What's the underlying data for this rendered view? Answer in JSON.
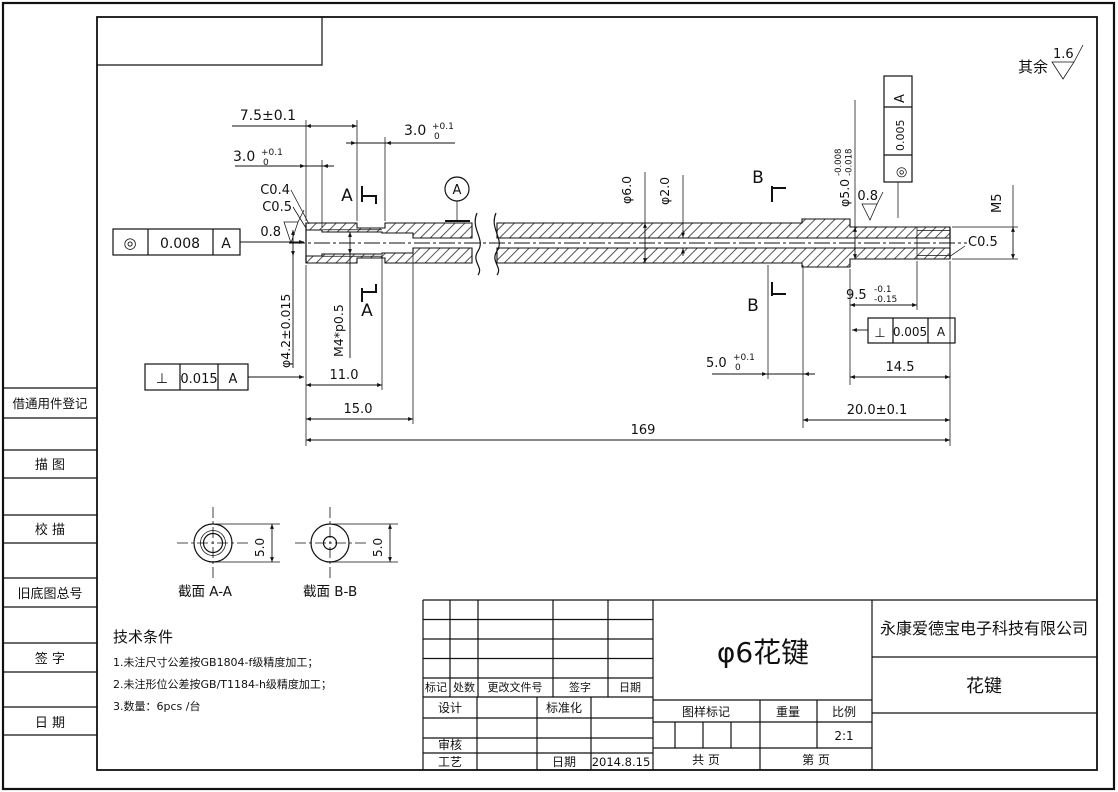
{
  "frame": {
    "margin_labels": [
      "借通用件登记",
      "描  图",
      "校  描",
      "旧底图总号",
      "签  字",
      "日  期"
    ]
  },
  "finish": {
    "prefix": "其余",
    "value": "1.6",
    "ra_left": "0.8",
    "ra_right": "0.8"
  },
  "dims": {
    "len_7_5": "7.5±0.1",
    "dep_3_0": {
      "v": "3.0",
      "sup": "+0.1",
      "sub": "0"
    },
    "grv_3_0": {
      "v": "3.0",
      "sup": "+0.1",
      "sub": "0"
    },
    "c0_4": "C0.4",
    "c0_5_left": "C0.5",
    "c0_5_right": "C0.5",
    "dia_4_2": "φ4.2±0.015",
    "thread_m4": "M4*p0.5",
    "thread_m5": "M5",
    "len_11": "11.0",
    "len_15": "15.0",
    "len_169": "169",
    "dia_6": "φ6.0",
    "dia_2": "φ2.0",
    "dia_5": {
      "v": "φ5.0",
      "sup": "-0.008",
      "sub": "-0.018"
    },
    "grv_5_0": {
      "v": "5.0",
      "sup": "+0.1",
      "sub": "0"
    },
    "len_9_5": {
      "v": "9.5",
      "sup": "-0.1",
      "sub": "-0.15"
    },
    "len_14_5": "14.5",
    "len_20": "20.0±0.1"
  },
  "gdt": {
    "conc_left": {
      "sym": "◎",
      "tol": "0.008",
      "datum": "A"
    },
    "perp_left": {
      "sym": "⊥",
      "tol": "0.015",
      "datum": "A"
    },
    "conc_right": {
      "sym": "◎",
      "tol": "0.005",
      "datum": "A"
    },
    "perp_right": {
      "sym": "⊥",
      "tol": "0.005",
      "datum": "A"
    }
  },
  "sections": {
    "a": "A",
    "b": "B",
    "datum": "A",
    "label_a": "截面  A-A",
    "label_b": "截面  B-B",
    "dim_a": "5.0",
    "dim_b": "5.0"
  },
  "notes": {
    "title": "技术条件",
    "items": [
      "1.未注尺寸公差按GB1804-f级精度加工；",
      "2.未注形位公差按GB/T1184-h级精度加工；",
      "3.数量：6pcs /台"
    ]
  },
  "titleblock": {
    "rev_headers": [
      "标记",
      "处数",
      "更改文件号",
      "签字",
      "日期"
    ],
    "design": "设计",
    "standardize": "标准化",
    "check": "审核",
    "process": "工艺",
    "date_label": "日期",
    "date": "2014.8.15",
    "part_title": "φ6花键",
    "mark_label": "图样标记",
    "weight_label": "重量",
    "scale_label": "比例",
    "scale": "2:1",
    "total_label": "共    页",
    "page_label": "第    页",
    "company": "永康爱德宝电子科技有限公司",
    "part_name": "花键"
  }
}
